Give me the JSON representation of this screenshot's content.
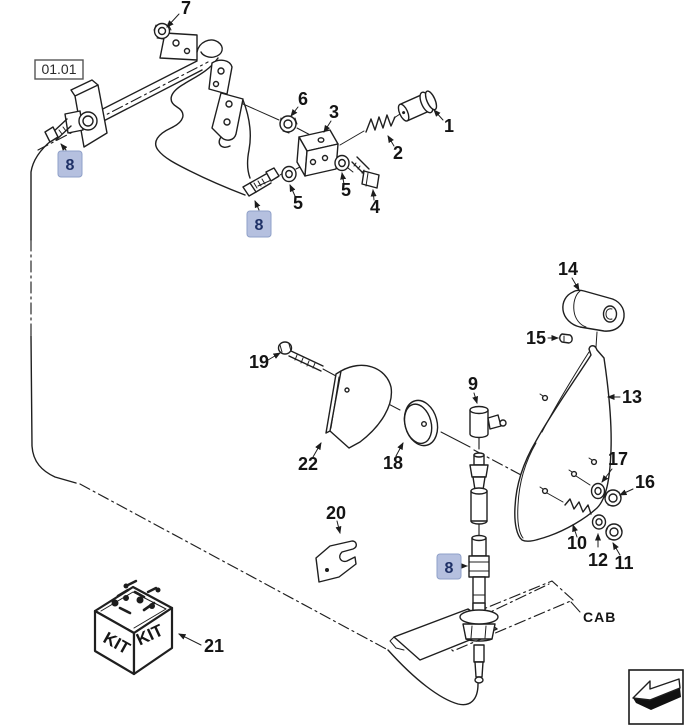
{
  "diagram": {
    "reference_box": {
      "label": "01.01"
    },
    "cab": {
      "label": "CAB"
    },
    "kit": {
      "label": "KIT"
    },
    "nav": {
      "icon": "return-arrow"
    },
    "highlight": {
      "bg": "#b5c0df",
      "border": "#8fa0c8",
      "text": "#1e3066"
    },
    "callouts": {
      "p1": "1",
      "p2": "2",
      "p3": "3",
      "p4": "4",
      "p5": "5",
      "p6": "6",
      "p7": "7",
      "p8": "8",
      "p9": "9",
      "p10": "10",
      "p11": "11",
      "p12": "12",
      "p13": "13",
      "p14": "14",
      "p15": "15",
      "p16": "16",
      "p17": "17",
      "p18": "18",
      "p19": "19",
      "p20": "20",
      "p21": "21",
      "p22": "22"
    }
  }
}
